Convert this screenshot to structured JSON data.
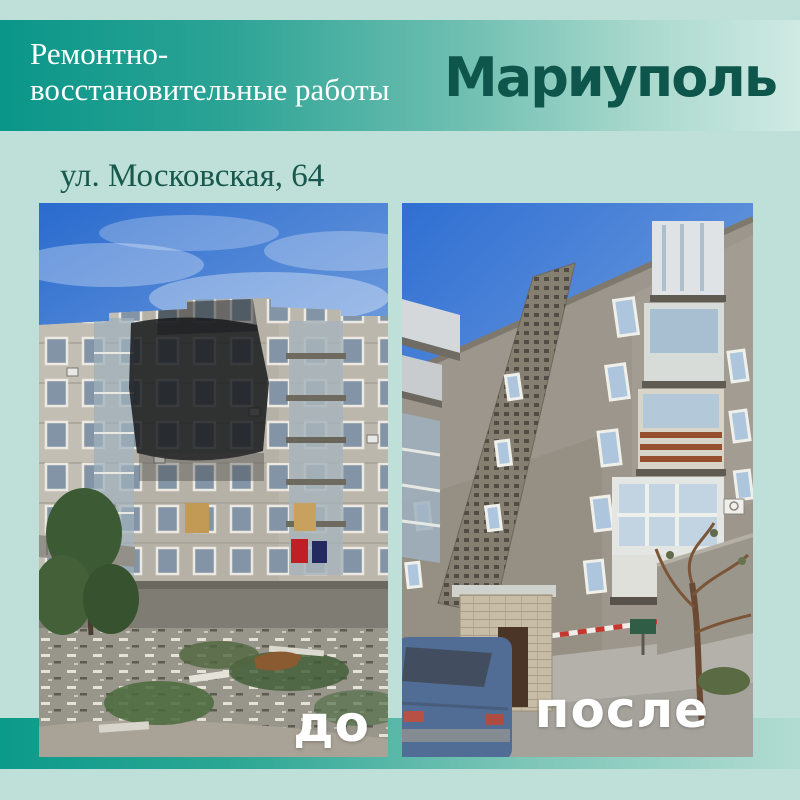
{
  "header": {
    "title_line1": "Ремонтно-",
    "title_line2": "восстановительные работы",
    "city": "Мариуполь"
  },
  "address": "ул. Московская, 64",
  "comparison": {
    "before_label": "до",
    "after_label": "после"
  },
  "colors": {
    "page_background": "#bfe0d8",
    "banner_gradient_left": "#0a9689",
    "banner_gradient_right": "#cfeae3",
    "banner_title_text": "#ffffff",
    "city_text": "#0e554b",
    "address_text": "#17594e",
    "bottom_bar_gradient_left": "#0c9a8a",
    "bottom_bar_gradient_right": "#b2dcd2",
    "photo_label_text": "#ffffff"
  }
}
